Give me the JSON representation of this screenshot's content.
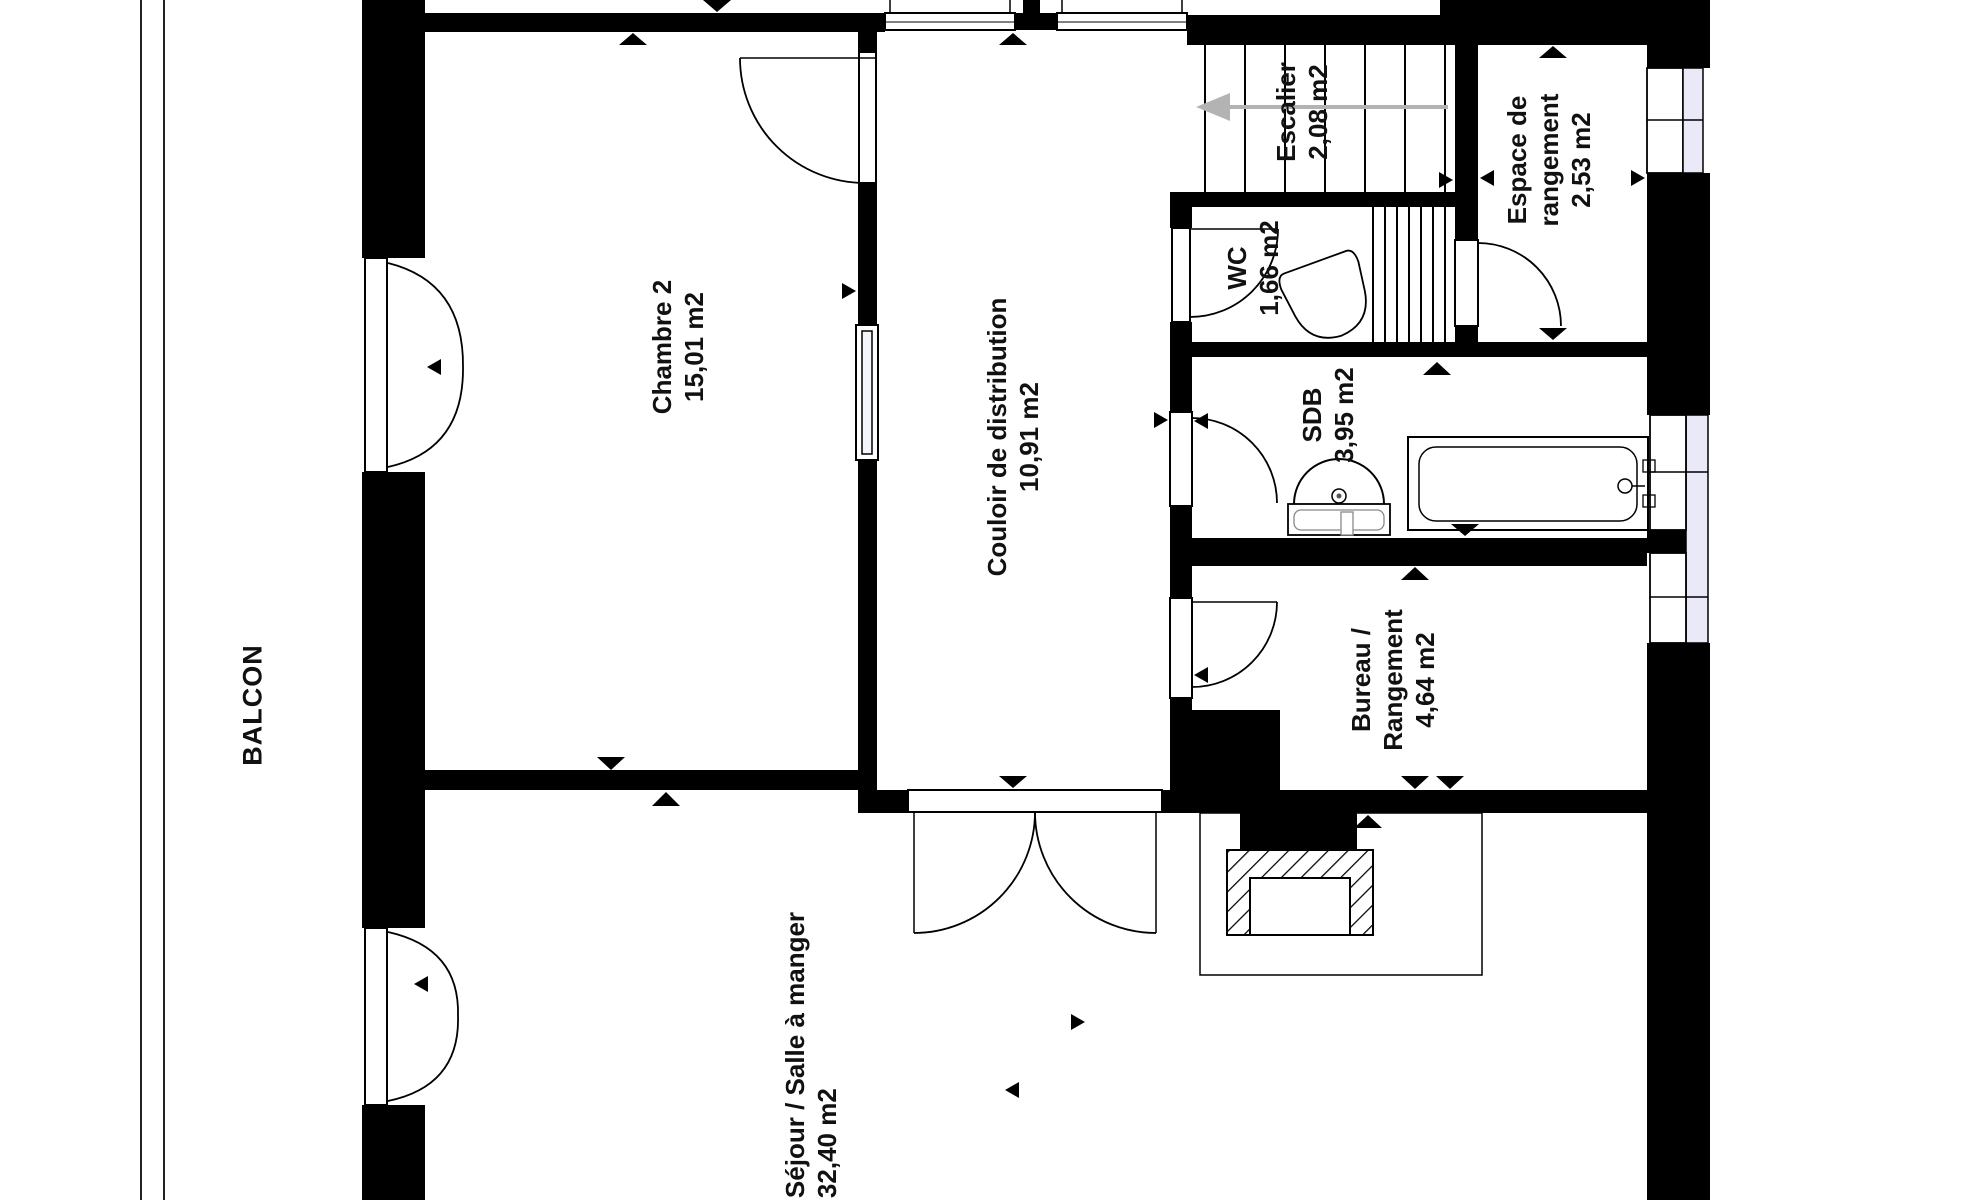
{
  "plan": {
    "title": "Floor plan",
    "balcony": {
      "label": "BALCON"
    },
    "rooms": [
      {
        "id": "chambre2",
        "lines": [
          "Chambre 2",
          "15,01 m2"
        ]
      },
      {
        "id": "couloir",
        "lines": [
          "Couloir de distribution",
          "10,91 m2"
        ]
      },
      {
        "id": "escalier",
        "lines": [
          "Escalier",
          "2,08 m2"
        ]
      },
      {
        "id": "wc",
        "lines": [
          "WC",
          "1,66 m2"
        ]
      },
      {
        "id": "espace-rangement",
        "lines": [
          "Espace de",
          "rangement",
          "2,53 m2"
        ]
      },
      {
        "id": "sdb",
        "lines": [
          "SDB",
          "3,95 m2"
        ]
      },
      {
        "id": "bureau",
        "lines": [
          "Bureau /",
          "Rangement",
          "4,64 m2"
        ]
      },
      {
        "id": "sejour",
        "lines": [
          "Séjour / Salle à manger",
          "32,40 m2"
        ]
      }
    ],
    "colors": {
      "wall": "#000000",
      "background": "#ffffff",
      "window_glass": "#e9e9f7",
      "sliding_door_panel": "#f4f4fb",
      "stair_arrow": "#b3b3b3"
    }
  }
}
